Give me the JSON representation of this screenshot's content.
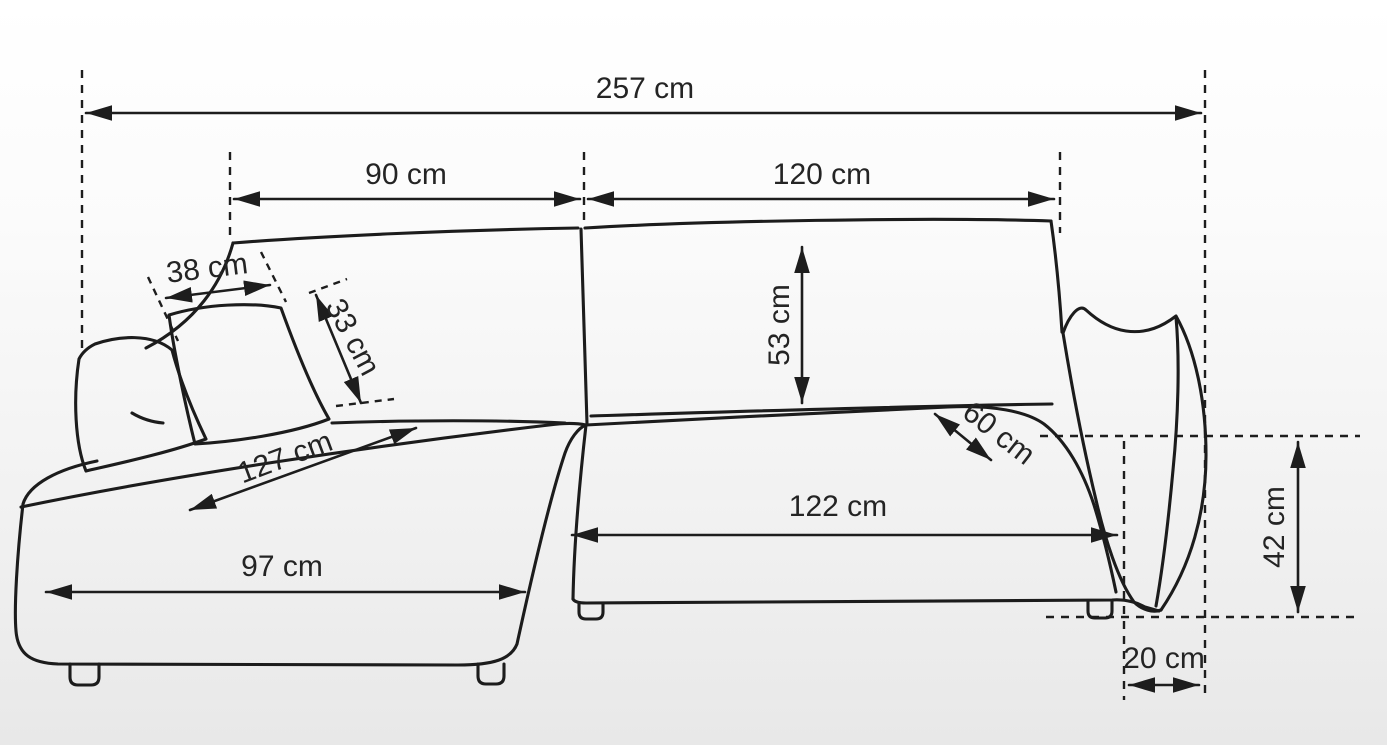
{
  "diagram": {
    "subject": "corner-sofa-dimension-drawing",
    "unit": "cm",
    "measurements": [
      {
        "id": "overall-width",
        "value": 257,
        "label": "257 cm"
      },
      {
        "id": "backrest-left-width",
        "value": 90,
        "label": "90 cm"
      },
      {
        "id": "backrest-right-width",
        "value": 120,
        "label": "120 cm"
      },
      {
        "id": "pillow-width",
        "value": 38,
        "label": "38 cm"
      },
      {
        "id": "pillow-height",
        "value": 33,
        "label": "33 cm"
      },
      {
        "id": "backrest-height",
        "value": 53,
        "label": "53 cm"
      },
      {
        "id": "chaise-diagonal-depth",
        "value": 127,
        "label": "127 cm"
      },
      {
        "id": "seat-depth",
        "value": 60,
        "label": "60 cm"
      },
      {
        "id": "chaise-front-width",
        "value": 97,
        "label": "97 cm"
      },
      {
        "id": "seat-front-width",
        "value": 122,
        "label": "122 cm"
      },
      {
        "id": "armrest-height",
        "value": 42,
        "label": "42 cm"
      },
      {
        "id": "armrest-width",
        "value": 20,
        "label": "20 cm"
      }
    ]
  },
  "colors": {
    "line": "#1c1c1c",
    "label": "#242424",
    "background_top": "#ffffff",
    "background_bottom": "#e8e8e8"
  }
}
